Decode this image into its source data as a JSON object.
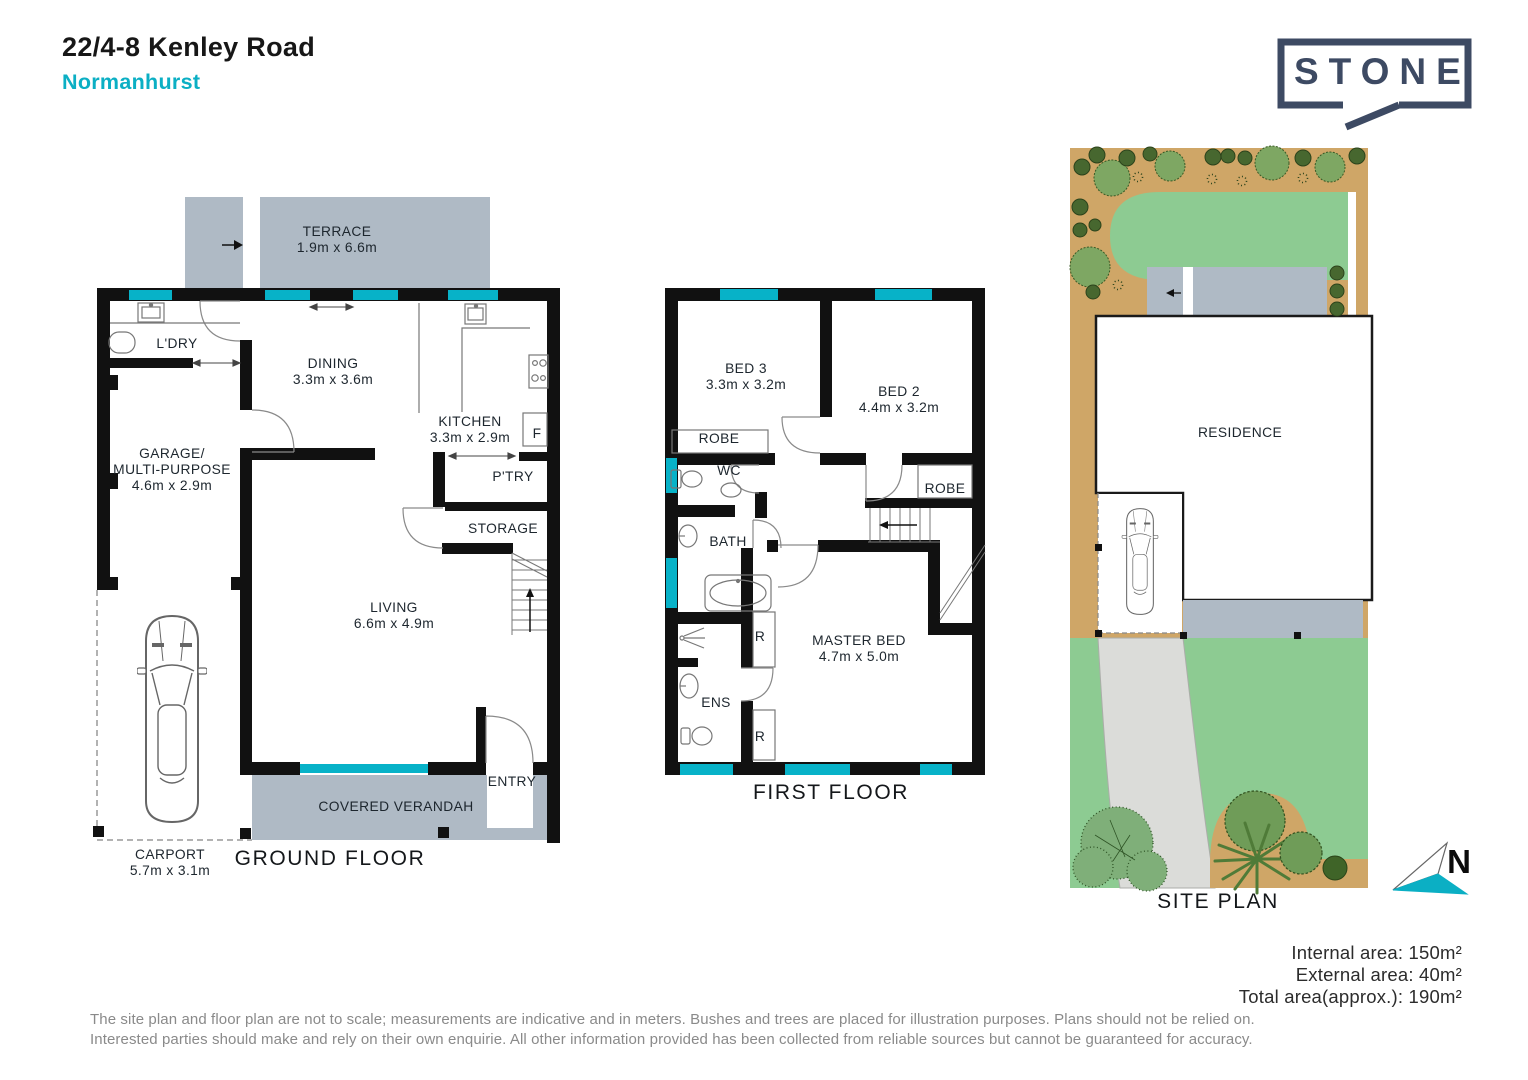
{
  "header": {
    "address": "22/4-8 Kenley Road",
    "suburb": "Normanhurst",
    "logo": "STONE"
  },
  "colors": {
    "accent_teal": "#0BAFC4",
    "window_teal": "#07B2C8",
    "wall_black": "#111111",
    "plan_gray": "#AFBAC5",
    "logo_navy": "#3D4A63",
    "site_tan": "#CFA667",
    "site_lawn": "#8DCB92",
    "site_driveway": "#DBDCD9"
  },
  "ground_floor": {
    "title": "GROUND FLOOR",
    "terrace_name": "TERRACE",
    "terrace_dims": "1.9m x 6.6m",
    "ldry": "L'DRY",
    "dining_name": "DINING",
    "dining_dims": "3.3m x 3.6m",
    "kitchen_name": "KITCHEN",
    "kitchen_dims": "3.3m x 2.9m",
    "fridge": "F",
    "pantry": "P'TRY",
    "storage": "STORAGE",
    "garage_line1": "GARAGE/",
    "garage_line2": "MULTI-PURPOSE",
    "garage_dims": "4.6m x 2.9m",
    "living_name": "LIVING",
    "living_dims": "6.6m x 4.9m",
    "entry": "ENTRY",
    "verandah": "COVERED VERANDAH",
    "carport_name": "CARPORT",
    "carport_dims": "5.7m x 3.1m"
  },
  "first_floor": {
    "title": "FIRST FLOOR",
    "bed3_name": "BED 3",
    "bed3_dims": "3.3m x 3.2m",
    "bed2_name": "BED 2",
    "bed2_dims": "4.4m x 3.2m",
    "robe1": "ROBE",
    "wc": "WC",
    "robe2": "ROBE",
    "bath": "BATH",
    "master_name": "MASTER BED",
    "master_dims": "4.7m x 5.0m",
    "r1": "R",
    "ens": "ENS",
    "r2": "R"
  },
  "site_plan": {
    "title": "SITE PLAN",
    "residence": "RESIDENCE",
    "north": "N"
  },
  "areas": {
    "internal": "Internal area: 150m²",
    "external": "External area: 40m²",
    "total": "Total area(approx.): 190m²"
  },
  "disclaimer": {
    "line1": "The site plan and floor plan are not to scale; measurements are indicative and in meters. Bushes and trees are placed for illustration purposes. Plans should not be relied on.",
    "line2": "Interested parties should make and rely on their own enquirie. All other information provided has been collected from reliable sources but cannot be guaranteed for accuracy."
  }
}
